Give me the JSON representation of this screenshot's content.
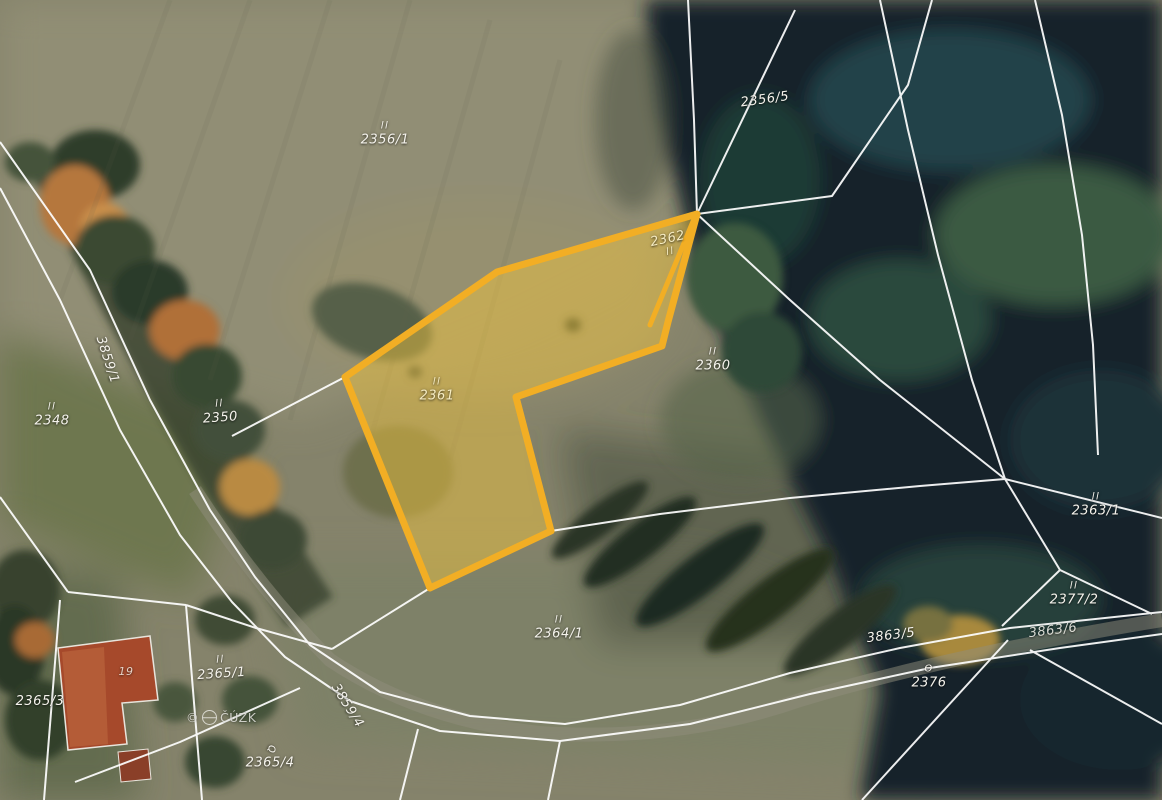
{
  "map": {
    "type": "cadastral-aerial-overlay",
    "attribution": {
      "prefix": "©",
      "name": "ČÚZK"
    },
    "colors": {
      "highlight_stroke": "#F2AE24",
      "highlight_fill": "rgba(246,200,60,0.45)",
      "boundary_line": "#FFFFFF",
      "label_text": "#F5F3EC",
      "label_cream": "#F6ECC2"
    },
    "highlighted_parcels": [
      "2361",
      "2362"
    ],
    "labels": [
      {
        "text": "2356/1",
        "symbol": "ll"
      },
      {
        "text": "2356/5",
        "symbol": ""
      },
      {
        "text": "2362",
        "symbol": "ll"
      },
      {
        "text": "2361",
        "symbol": "ll"
      },
      {
        "text": "2360",
        "symbol": "ll"
      },
      {
        "text": "2348",
        "symbol": "ll"
      },
      {
        "text": "2350",
        "symbol": "ll"
      },
      {
        "text": "3859/1",
        "symbol": ""
      },
      {
        "text": "2363/1",
        "symbol": "ll"
      },
      {
        "text": "2377/2",
        "symbol": "ll"
      },
      {
        "text": "3863/5",
        "symbol": ""
      },
      {
        "text": "3863/6",
        "symbol": ""
      },
      {
        "text": "2376",
        "symbol": "Ɵ"
      },
      {
        "text": "2364/1",
        "symbol": "ll"
      },
      {
        "text": "2365/1",
        "symbol": "ll"
      },
      {
        "text": "2365/3",
        "symbol": ""
      },
      {
        "text": "2365/4",
        "symbol": "Q"
      },
      {
        "text": "3859/4",
        "symbol": ""
      },
      {
        "text": "19",
        "symbol": ""
      }
    ]
  }
}
